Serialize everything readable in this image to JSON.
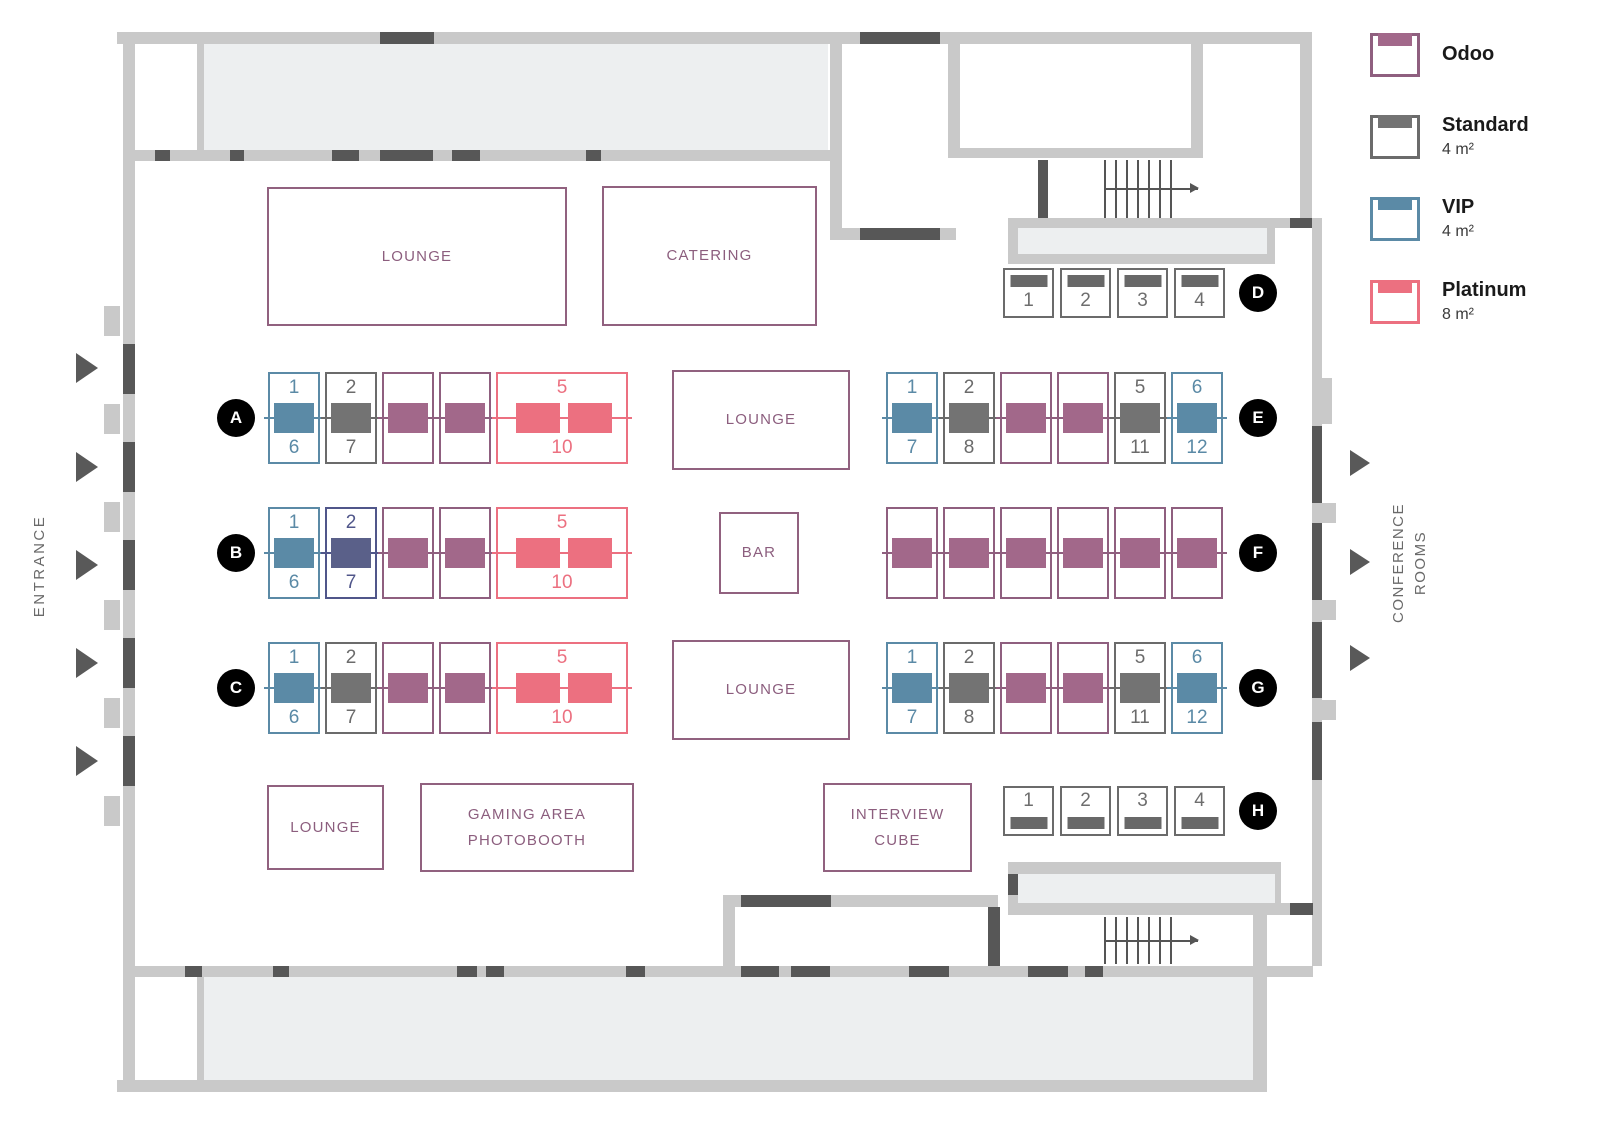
{
  "legend": {
    "items": [
      {
        "type": "odoo",
        "label": "Odoo",
        "size": ""
      },
      {
        "type": "standard",
        "label": "Standard",
        "size": "4 m²"
      },
      {
        "type": "vip",
        "label": "VIP",
        "size": "4 m²"
      },
      {
        "type": "platinum",
        "label": "Platinum",
        "size": "8 m²"
      }
    ]
  },
  "booth_types": {
    "odoo": {
      "name": "Odoo",
      "border": "#8f5f7f",
      "fill": "#a2688a"
    },
    "standard": {
      "name": "Standard",
      "border": "#6b6b6b",
      "fill": "#737373"
    },
    "vip": {
      "name": "VIP",
      "border": "#5b8aa6",
      "fill": "#5b8aa6"
    },
    "platinum": {
      "name": "Platinum",
      "border": "#ec7080",
      "fill": "#ec7080"
    },
    "reserved": {
      "name": "Reserved",
      "border": "#50568a",
      "fill": "#5a6089"
    }
  },
  "areas": {
    "lounge_top": "LOUNGE",
    "catering": "CATERING",
    "lounge_center_top": "LOUNGE",
    "bar": "BAR",
    "lounge_center_bottom": "LOUNGE",
    "lounge_bottom": "LOUNGE",
    "gaming_line1": "GAMING AREA",
    "gaming_line2": "PHOTOBOOTH",
    "interview_line1": "INTERVIEW",
    "interview_line2": "CUBE"
  },
  "labels": {
    "entrance": "ENTRANCE",
    "conference_line1": "CONFERENCE",
    "conference_line2": "ROOMS"
  },
  "rows": [
    {
      "id": "A",
      "booths": [
        {
          "type": "vip",
          "top": "1",
          "bottom": "6"
        },
        {
          "type": "standard",
          "top": "2",
          "bottom": "7"
        },
        {
          "type": "odoo"
        },
        {
          "type": "odoo"
        },
        {
          "type": "platinum",
          "top": "5",
          "bottom": "10"
        }
      ]
    },
    {
      "id": "B",
      "booths": [
        {
          "type": "vip",
          "top": "1",
          "bottom": "6"
        },
        {
          "type": "reserved",
          "top": "2",
          "bottom": "7"
        },
        {
          "type": "odoo"
        },
        {
          "type": "odoo"
        },
        {
          "type": "platinum",
          "top": "5",
          "bottom": "10"
        }
      ]
    },
    {
      "id": "C",
      "booths": [
        {
          "type": "vip",
          "top": "1",
          "bottom": "6"
        },
        {
          "type": "standard",
          "top": "2",
          "bottom": "7"
        },
        {
          "type": "odoo"
        },
        {
          "type": "odoo"
        },
        {
          "type": "platinum",
          "top": "5",
          "bottom": "10"
        }
      ]
    },
    {
      "id": "D",
      "bar": "top",
      "booths": [
        {
          "type": "standard",
          "num": "1"
        },
        {
          "type": "standard",
          "num": "2"
        },
        {
          "type": "standard",
          "num": "3"
        },
        {
          "type": "standard",
          "num": "4"
        }
      ]
    },
    {
      "id": "E",
      "booths": [
        {
          "type": "vip",
          "top": "1",
          "bottom": "7"
        },
        {
          "type": "standard",
          "top": "2",
          "bottom": "8"
        },
        {
          "type": "odoo"
        },
        {
          "type": "odoo"
        },
        {
          "type": "standard",
          "top": "5",
          "bottom": "11"
        },
        {
          "type": "vip",
          "top": "6",
          "bottom": "12"
        }
      ]
    },
    {
      "id": "F",
      "booths": [
        {
          "type": "odoo"
        },
        {
          "type": "odoo"
        },
        {
          "type": "odoo"
        },
        {
          "type": "odoo"
        },
        {
          "type": "odoo"
        },
        {
          "type": "odoo"
        }
      ]
    },
    {
      "id": "G",
      "booths": [
        {
          "type": "vip",
          "top": "1",
          "bottom": "7"
        },
        {
          "type": "standard",
          "top": "2",
          "bottom": "8"
        },
        {
          "type": "odoo"
        },
        {
          "type": "odoo"
        },
        {
          "type": "standard",
          "top": "5",
          "bottom": "11"
        },
        {
          "type": "vip",
          "top": "6",
          "bottom": "12"
        }
      ]
    },
    {
      "id": "H",
      "bar": "bottom",
      "booths": [
        {
          "type": "standard",
          "num": "1"
        },
        {
          "type": "standard",
          "num": "2"
        },
        {
          "type": "standard",
          "num": "3"
        },
        {
          "type": "standard",
          "num": "4"
        }
      ]
    }
  ],
  "palette": {
    "wall": "#c9c9c9",
    "door": "#575757",
    "room_fill": "#edeff0",
    "area_border": "#91617f",
    "row_circle": "#000000"
  }
}
